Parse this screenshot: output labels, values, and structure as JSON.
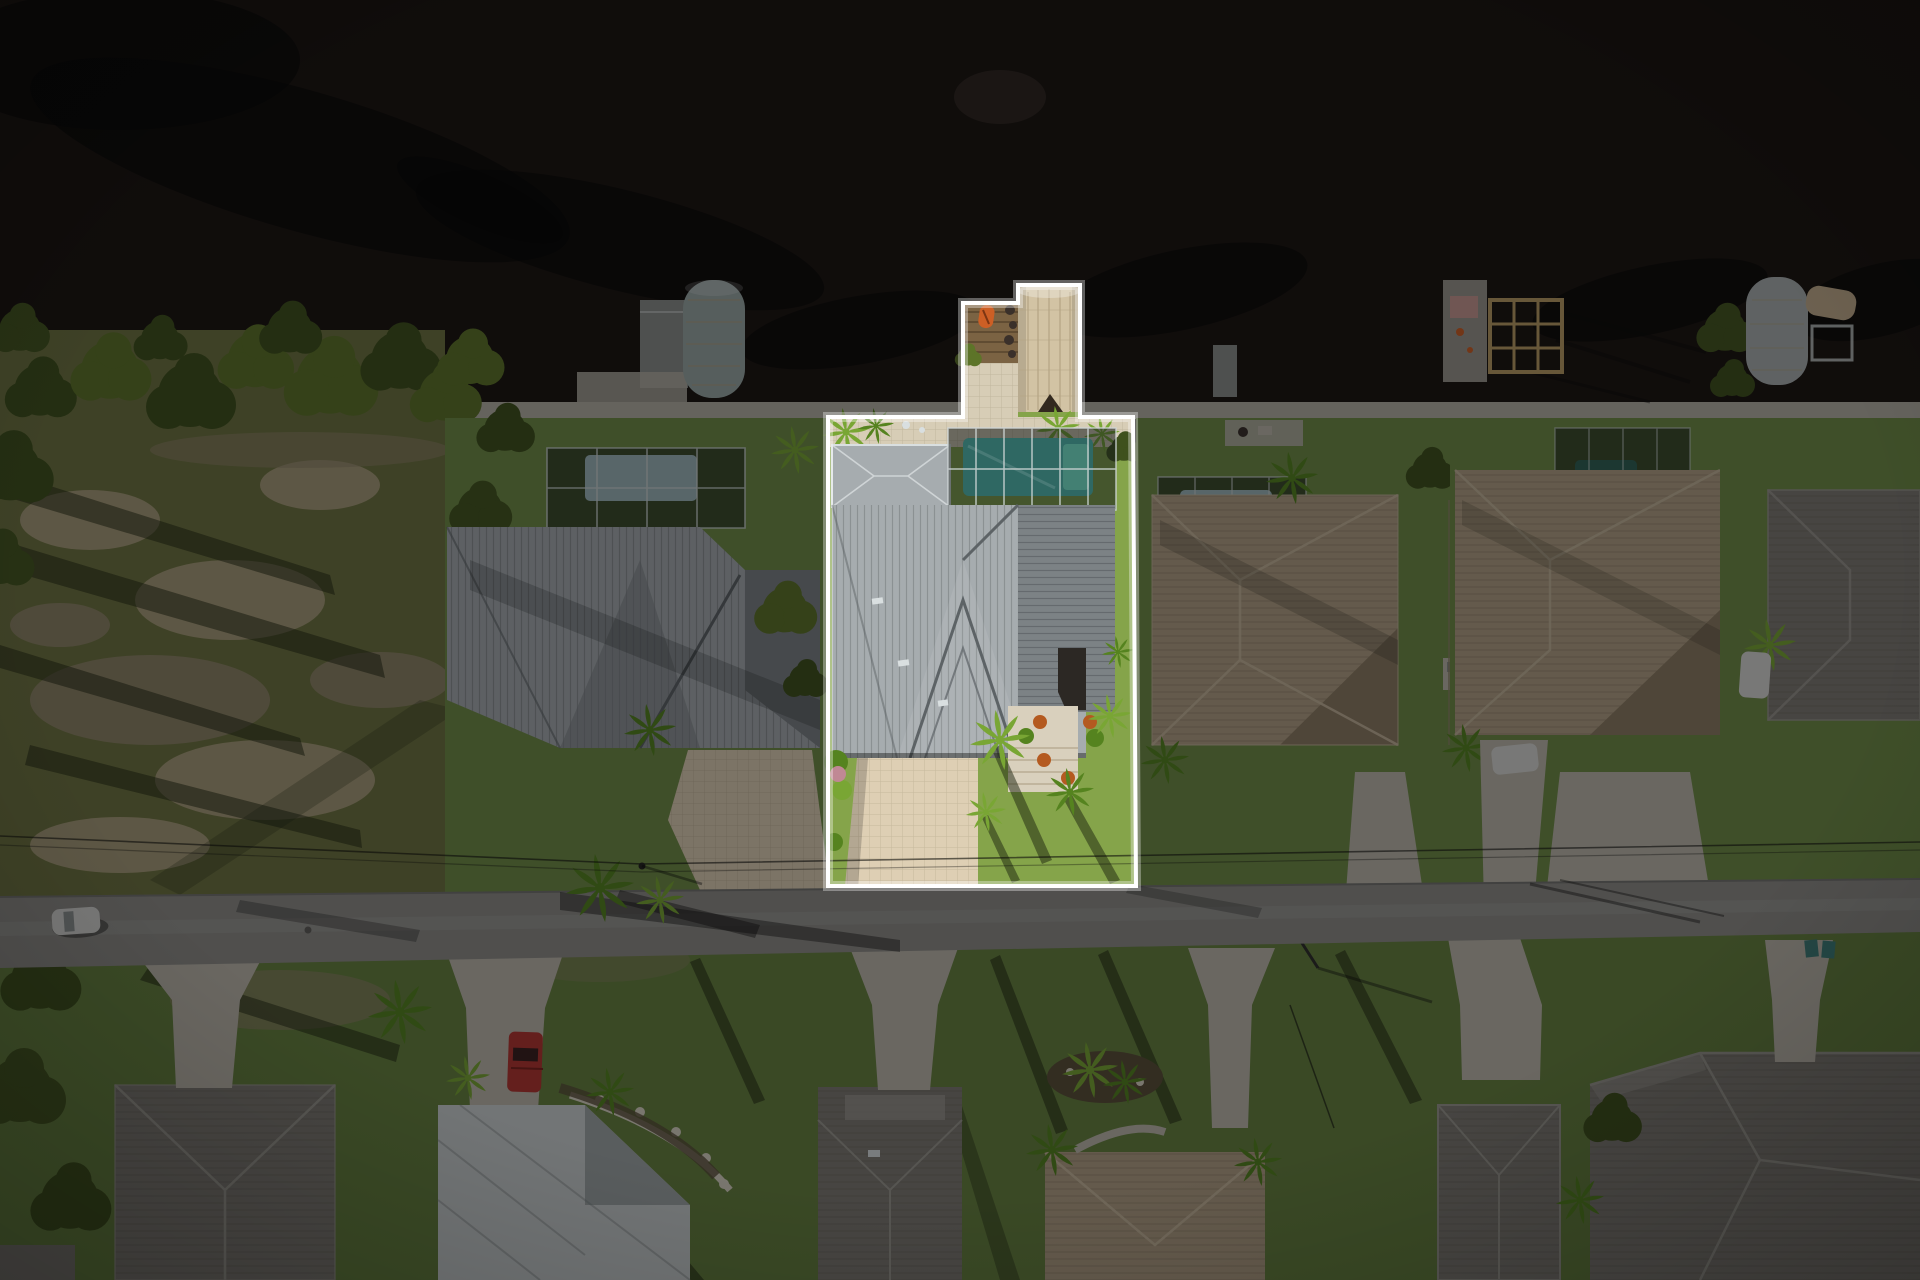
{
  "meta": {
    "description": "Aerial drone photograph of a waterfront canal neighborhood at golden hour; one residential lot is highlighted with a white property-boundary outline while the rest of the scene is darkened",
    "width_px": 1920,
    "height_px": 1280,
    "visible_text": "none"
  },
  "palette": {
    "water": "#1a1410",
    "water_light": "#2e2620",
    "water_shadow": "rgba(6,5,3,0.55)",
    "seawall": "#b5b1a5",
    "olive": "#6e7440",
    "sand": "#a79c78",
    "sand_dark": "#8d8465",
    "tree_dark": "#3f511d",
    "tree_light": "#5d7428",
    "hedge": "#44561f",
    "palm_bright": "#79a634",
    "palm_deep": "#55831f",
    "lawn": "#6f8c46",
    "lawn_bright": "#85a44a",
    "lawn_dim": "#66813f",
    "metal_roof": "#a6acaf",
    "metal_roof_dark": "#7c8285",
    "metal_seam": "#5d6366",
    "white_frame": "#d9dfe0",
    "cage": "rgba(16,22,22,0.55)",
    "cage_frame": "#cfd6d6",
    "pool_teal": "#2f6863",
    "pool_teal_light": "#438073",
    "pool_pale": "#9db6ba",
    "deck": "#d7cdb6",
    "paver": "#decfb4",
    "concrete": "#bdb9ac",
    "road": "#8e8d88",
    "wood": "#7b6343",
    "rock": "#3a302a",
    "kayak": "#cd5f25",
    "canopy_tan": "#d2c3a4",
    "canopy_tan_rib": "#b3a382",
    "canopy_gray": "#9aa8a5",
    "canopy_silver": "#a9b0b0",
    "roof_tan": "#b2a185",
    "roof_tan_dark": "#8d7d63",
    "roof_tan_light": "#c6b79c",
    "roof_gray": "#7e7b74",
    "roof_gray_light": "#9a978f",
    "roof_white": "#cdd1d1",
    "roof_white_dark": "#9fa6a6",
    "truck_red": "#b23530",
    "vehicle_white": "#d8d8d4",
    "bin_teal": "#3f7f78",
    "pot_orange": "#b45a20",
    "flower_pink": "#c08894",
    "mulch": "#5a4f38",
    "stone": "#d9d3c4",
    "steps": "#d9d0bd",
    "step_line": "#b9ac93",
    "barge": "#9a958c",
    "tarp_pink": "#c99a93",
    "timber": "#b89b63",
    "boat_tan": "#c4ae8c",
    "dock_gray": "#8b8e8a",
    "shadow_streak": "rgba(28,34,14,0.5)",
    "shadow_soft": "rgba(10,10,8,0.4)",
    "outline": "#ffffff",
    "glow": "rgba(255,255,255,0.35)",
    "dim": "rgba(4,5,7,0.45)",
    "wire": "rgba(15,15,12,0.6)"
  },
  "scene": {
    "type": "real-estate aerial photo",
    "water_body": "canal",
    "highlighted_lot": {
      "boundary_style": "white outline, surroundings dimmed",
      "features": [
        "wood dock with orange kayak",
        "tan boat-lift canopy",
        "screened pool enclosure with teal pool",
        "gray standing-seam metal roof house",
        "cream paver driveway",
        "front entry steps with orange planters",
        "palm trees"
      ]
    },
    "neighbors": [
      "vacant scrub lot with shoreline trees (left)",
      "gray metal roof home with pool cage and cylindrical boat cover (left)",
      "tan shingle roof homes with pool cages (right)",
      "timber boat-lift frame dock and silver boat-lift canopy (far right)"
    ],
    "street": {
      "orientation": "horizontal",
      "vehicles": [
        "white car on road (left)",
        "red pickup in driveway (bottom)",
        "white vehicle (right)"
      ],
      "power_lines": true
    },
    "bottom_row": [
      "gray shingle roof homes",
      "white metal roof home with stone landscape border",
      "concrete driveways",
      "palm trees with long shadows",
      "teal trash bins"
    ]
  }
}
